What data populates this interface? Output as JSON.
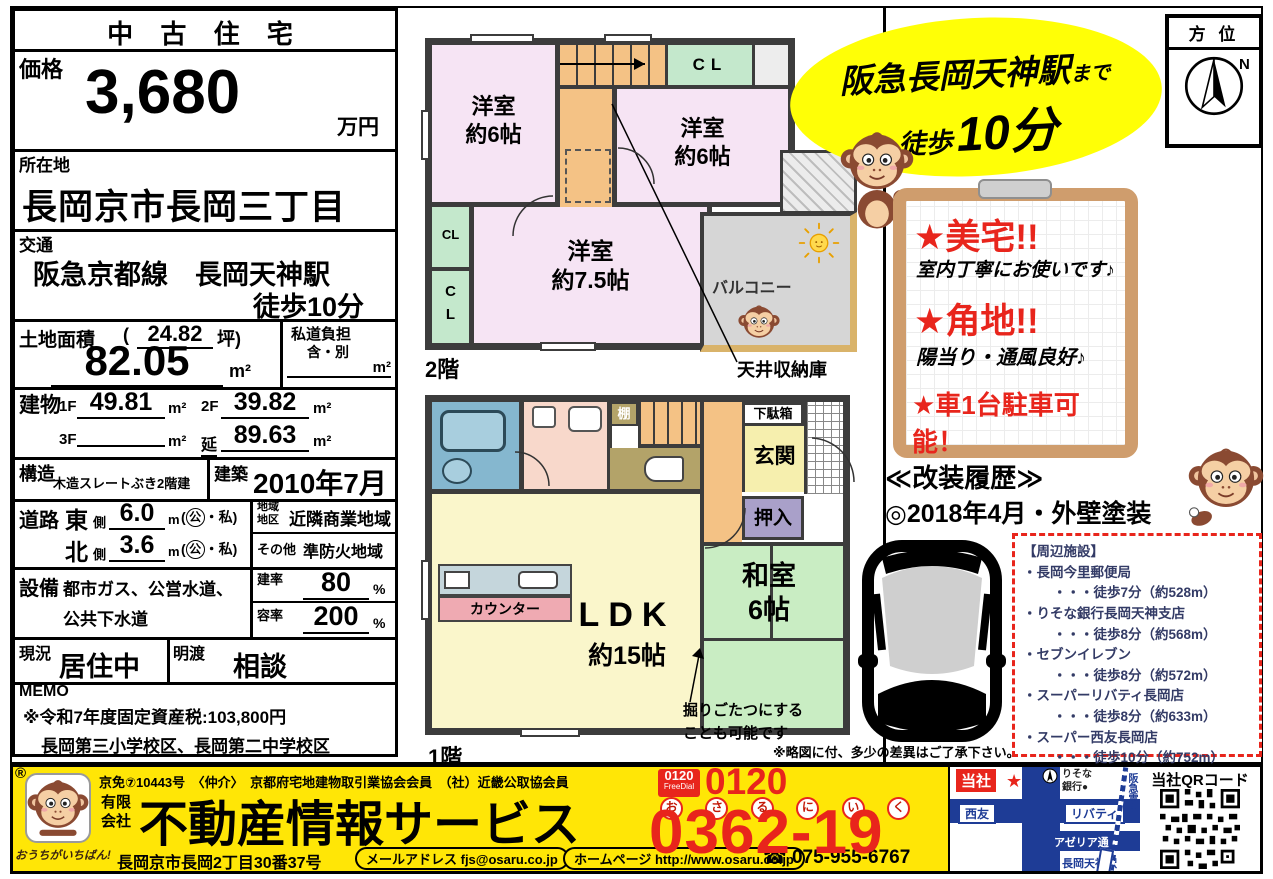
{
  "info": {
    "header": "中 古 住 宅",
    "price_label": "価格",
    "price_value": "3,680",
    "price_unit": "万円",
    "location_label": "所在地",
    "location_value": "長岡京市長岡三丁目",
    "transport_label": "交通",
    "transport_line1": "阪急京都線　長岡天神駅",
    "transport_line2": "徒歩10分",
    "land_label": "土地面積",
    "paren_open": "(",
    "land_tsubo": "24.82",
    "tsubo_close": "坪)",
    "land_value": "82.05",
    "sqm": "m²",
    "shido_label": "私道負担",
    "shido_sub": "含・別",
    "building_label": "建物",
    "f1_label": "1F",
    "f1_value": "49.81",
    "f2_label": "2F",
    "f2_value": "39.82",
    "f3_label": "3F",
    "nobe_label": "延",
    "nobe_value": "89.63",
    "structure_label": "構造",
    "structure_value": "木造スレートぶき2階建",
    "built_label": "建築",
    "built_value": "2010年7月",
    "road_label": "道路",
    "road1_dir": "東",
    "side": "側",
    "road1_w": "6.0",
    "m_unit": "m",
    "kakko_open": "(",
    "kou": "公",
    "kakko_rest": "・私)",
    "road2_dir": "北",
    "road2_w": "3.6",
    "zone_label1": "地域",
    "zone_label2": "地区",
    "zone_value": "近隣商業地域",
    "other_label": "その他",
    "other_value": "準防火地域",
    "equip_label": "設備",
    "equip_line1": "都市ガス、公営水道、",
    "equip_line2": "公共下水道",
    "kenpei_label": "建率",
    "kenpei_value": "80",
    "percent": "%",
    "yoseki_label": "容率",
    "yoseki_value": "200",
    "status_label": "現況",
    "status_value": "居住中",
    "handover_label": "明渡",
    "handover_value": "相談",
    "memo_label": "MEMO",
    "memo_line1": "※令和7年度固定資産税:103,800円",
    "memo_line2": "長岡第三小学校区、長岡第二中学校区"
  },
  "plan2f": {
    "floor_label": "2階",
    "room_a1": "洋室",
    "room_a2": "約6帖",
    "room_b1": "洋室",
    "room_b2": "約6帖",
    "room_c1": "洋室",
    "room_c2": "約7.5帖",
    "cl": "CL",
    "cl_c": "C",
    "cl_l": "L",
    "balcony": "バルコニー",
    "ceiling_note": "天井収納庫"
  },
  "plan1f": {
    "floor_label": "1階",
    "ldk1": "LDK",
    "ldk2": "約15帖",
    "washitsu1": "和室",
    "washitsu2": "6帖",
    "counter": "カウンター",
    "shelf": "棚",
    "getabako": "下駄箱",
    "genkan": "玄関",
    "oshiire": "押入",
    "kotatsu1": "掘りごたつにする",
    "kotatsu2": "ことも可能です",
    "note": "※略図に付、多少の差異はご了承下さい。"
  },
  "highlight": {
    "line1": "阪急長岡天神駅",
    "line1_suffix": "まで",
    "walk": "徒歩",
    "minutes": "10分"
  },
  "compass": {
    "label": "方 位",
    "n": "N"
  },
  "board": {
    "t1": "★美宅!!",
    "s1": "室内丁寧にお使いです♪",
    "t2": "★角地!!",
    "s2": "陽当り・通風良好♪",
    "t3": "★車1台駐車可能！"
  },
  "renovation": {
    "title": "≪改装履歴≫",
    "item": "◎2018年4月・外壁塗装"
  },
  "facilities": {
    "title": "【周辺施設】",
    "items": [
      {
        "name": "・長岡今里郵便局",
        "dist": "・・・徒歩7分（約528m）"
      },
      {
        "name": "・りそな銀行長岡天神支店",
        "dist": "・・・徒歩8分（約568m）"
      },
      {
        "name": "・セブンイレブン",
        "dist": "・・・徒歩8分（約572m）"
      },
      {
        "name": "・スーパーリバティ長岡店",
        "dist": "・・・徒歩8分（約633m）"
      },
      {
        "name": "・スーパー西友長岡店",
        "dist": "・・・徒歩10分（約752m）"
      }
    ]
  },
  "footer": {
    "reg": "®",
    "license": "京免⑦10443号　〈仲介〉　京都府宅地建物取引業協会会員　（社）近畿公取協会員",
    "company_prefix1": "有限",
    "company_prefix2": "会社",
    "company": "不動産情報サービス",
    "slogan": "おうちがいちばん!",
    "address": "長岡京市長岡2丁目30番37号",
    "email_pill": "メールアドレス fjs@osaru.co.jp",
    "web_pill": "ホームページ http://www.osaru.co.jp",
    "tel2": "☎ 075-955-6767",
    "freedial_line1": "0120",
    "freedial_line2": "FreeDial",
    "freedial_top": "0120",
    "phone_digits": "0362-19",
    "furigana": [
      "お",
      "さ",
      "る",
      "に",
      "い",
      "く"
    ],
    "colors": {
      "band": "#ffe606",
      "red": "#e8251c",
      "map_blue": "#1e3c96"
    }
  },
  "map": {
    "company_tag": "当社",
    "star": "★",
    "bank1": "りそな",
    "bank2": "銀行●",
    "seiyu": "西友",
    "liberty": "リバティ",
    "azeria": "アゼリア通",
    "station": "長岡天神駅",
    "hankyu": "阪急電車",
    "qr_label": "当社QRコード"
  }
}
